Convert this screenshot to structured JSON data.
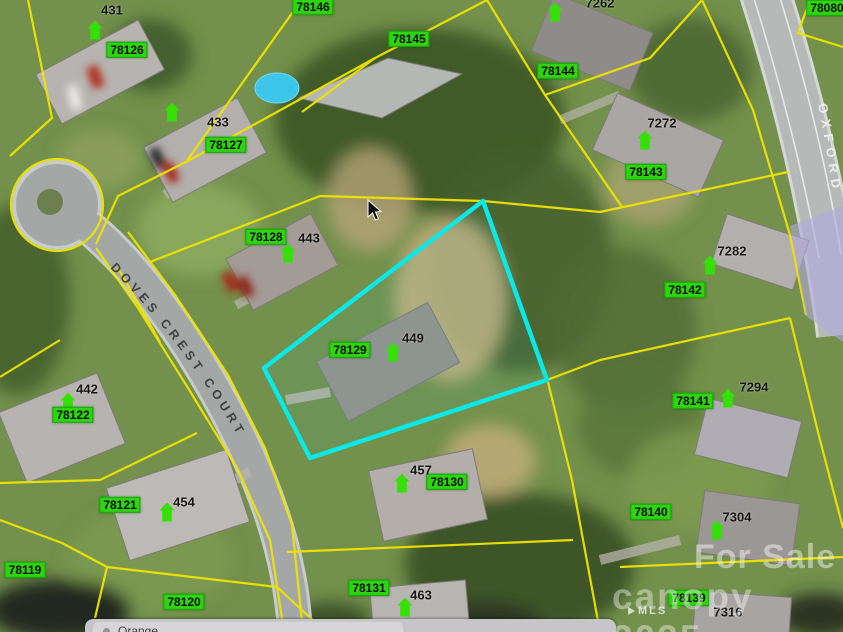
{
  "colors": {
    "parcel_line": "#f0e400",
    "highlight_outline": "#0ae8e8",
    "label_background": "#2fd30f",
    "road_overlay": "#b3a8dd",
    "marker_green": "#35e006"
  },
  "streets": [
    {
      "name": "DOVES CREST COURT"
    },
    {
      "name": "OXFORD"
    }
  ],
  "parcel_labels": [
    {
      "text": "78126",
      "x": 127,
      "y": 50
    },
    {
      "text": "78146",
      "x": 313,
      "y": 7
    },
    {
      "text": "78145",
      "x": 409,
      "y": 39
    },
    {
      "text": "78144",
      "x": 558,
      "y": 71
    },
    {
      "text": "78080",
      "x": 827,
      "y": 8
    },
    {
      "text": "78127",
      "x": 226,
      "y": 145
    },
    {
      "text": "78143",
      "x": 646,
      "y": 172
    },
    {
      "text": "78128",
      "x": 266,
      "y": 237
    },
    {
      "text": "78142",
      "x": 685,
      "y": 290
    },
    {
      "text": "78129",
      "x": 350,
      "y": 350
    },
    {
      "text": "78122",
      "x": 73,
      "y": 415
    },
    {
      "text": "78141",
      "x": 693,
      "y": 401
    },
    {
      "text": "78121",
      "x": 120,
      "y": 505
    },
    {
      "text": "78130",
      "x": 447,
      "y": 482
    },
    {
      "text": "78140",
      "x": 651,
      "y": 512
    },
    {
      "text": "78119",
      "x": 25,
      "y": 570
    },
    {
      "text": "78120",
      "x": 184,
      "y": 602
    },
    {
      "text": "78131",
      "x": 369,
      "y": 588
    },
    {
      "text": "78139",
      "x": 689,
      "y": 598
    }
  ],
  "house_numbers": [
    {
      "text": "431",
      "x": 112,
      "y": 10
    },
    {
      "text": "433",
      "x": 218,
      "y": 122
    },
    {
      "text": "443",
      "x": 309,
      "y": 238
    },
    {
      "text": "449",
      "x": 413,
      "y": 338
    },
    {
      "text": "442",
      "x": 87,
      "y": 389
    },
    {
      "text": "454",
      "x": 184,
      "y": 502
    },
    {
      "text": "457",
      "x": 421,
      "y": 470
    },
    {
      "text": "463",
      "x": 421,
      "y": 595
    },
    {
      "text": "7262",
      "x": 600,
      "y": 3
    },
    {
      "text": "7272",
      "x": 662,
      "y": 123
    },
    {
      "text": "7282",
      "x": 732,
      "y": 251
    },
    {
      "text": "7294",
      "x": 754,
      "y": 387
    },
    {
      "text": "7304",
      "x": 737,
      "y": 517
    },
    {
      "text": "7316",
      "x": 728,
      "y": 612
    }
  ],
  "markers": [
    {
      "x": 95,
      "y": 30
    },
    {
      "x": 172,
      "y": 112
    },
    {
      "x": 555,
      "y": 12
    },
    {
      "x": 645,
      "y": 140
    },
    {
      "x": 288,
      "y": 253
    },
    {
      "x": 710,
      "y": 265
    },
    {
      "x": 393,
      "y": 352
    },
    {
      "x": 68,
      "y": 402
    },
    {
      "x": 728,
      "y": 398
    },
    {
      "x": 167,
      "y": 512
    },
    {
      "x": 402,
      "y": 483
    },
    {
      "x": 717,
      "y": 530
    },
    {
      "x": 405,
      "y": 607
    },
    {
      "x": 676,
      "y": 598
    }
  ],
  "highlight_parcel": {
    "points": "483,201 547,380 310,458 264,368"
  },
  "watermark": {
    "line1": "For Sale",
    "line2": "canopy 2025",
    "mls": "MLS"
  },
  "bottom_bar": {
    "label": "Orange"
  }
}
